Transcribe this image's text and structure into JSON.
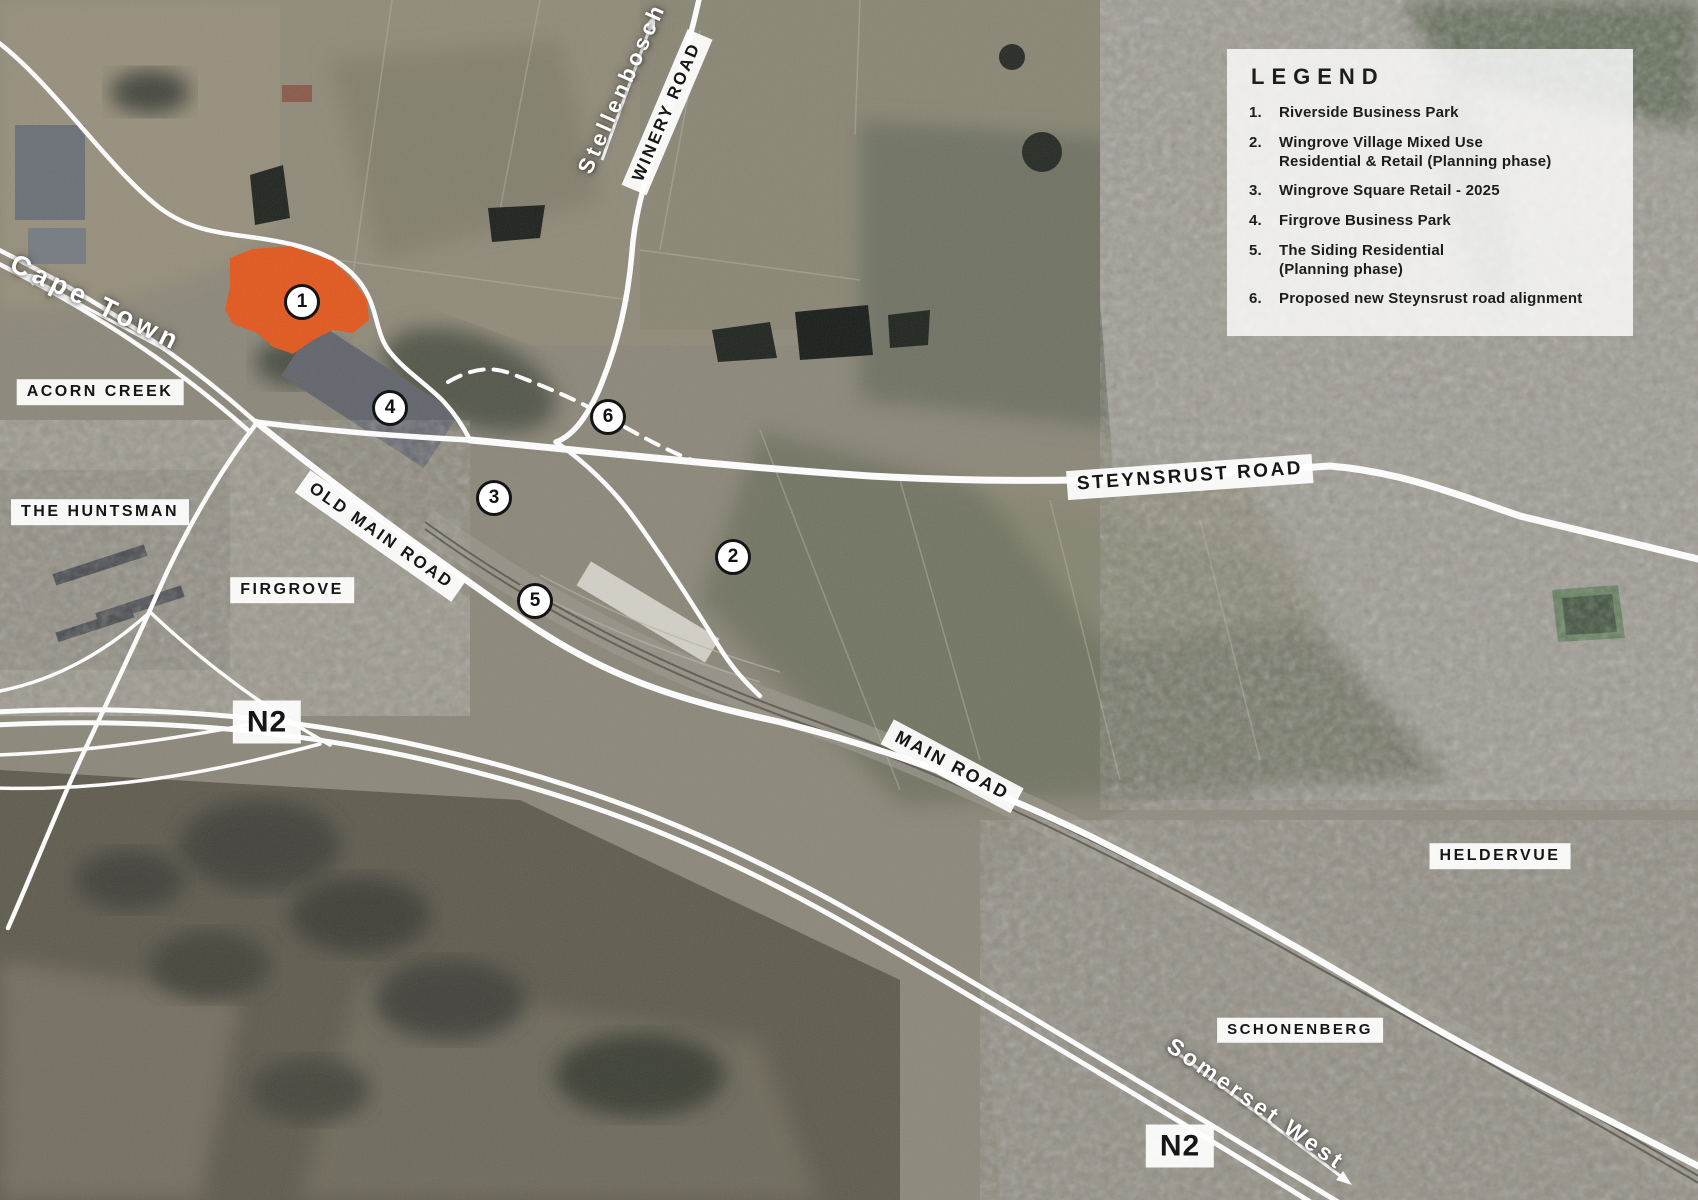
{
  "legend": {
    "title": "LEGEND",
    "items": [
      {
        "num": "1.",
        "text": "Riverside Business Park"
      },
      {
        "num": "2.",
        "text": "Wingrove Village Mixed Use\nResidential & Retail (Planning phase)"
      },
      {
        "num": "3.",
        "text": "Wingrove Square Retail - 2025"
      },
      {
        "num": "4.",
        "text": "Firgrove Business Park"
      },
      {
        "num": "5.",
        "text": "The Siding Residential\n(Planning phase)"
      },
      {
        "num": "6.",
        "text": "Proposed new Steynsrust road alignment"
      }
    ]
  },
  "markers": [
    {
      "label": "1"
    },
    {
      "label": "2"
    },
    {
      "label": "3"
    },
    {
      "label": "4"
    },
    {
      "label": "5"
    },
    {
      "label": "6"
    }
  ],
  "roads": {
    "winery": "WINERY ROAD",
    "steynsrust": "STEYNSRUST ROAD",
    "old_main": "OLD MAIN ROAD",
    "main": "MAIN ROAD",
    "n2_west": "N2",
    "n2_south": "N2"
  },
  "areas": {
    "acorn_creek": "ACORN CREEK",
    "huntsman": "THE HUNTSMAN",
    "firgrove": "FIRGROVE",
    "heldervue": "HELDERVUE",
    "schonenberg": "SCHONENBERG"
  },
  "directions": {
    "cape_town": "Cape Town",
    "stellenbosch": "Stellenbosch",
    "somerset_west": "Somerset West"
  },
  "colors": {
    "highlight_orange": "#E2571D",
    "road_white": "#FFFFFF",
    "label_text": "#161616"
  }
}
